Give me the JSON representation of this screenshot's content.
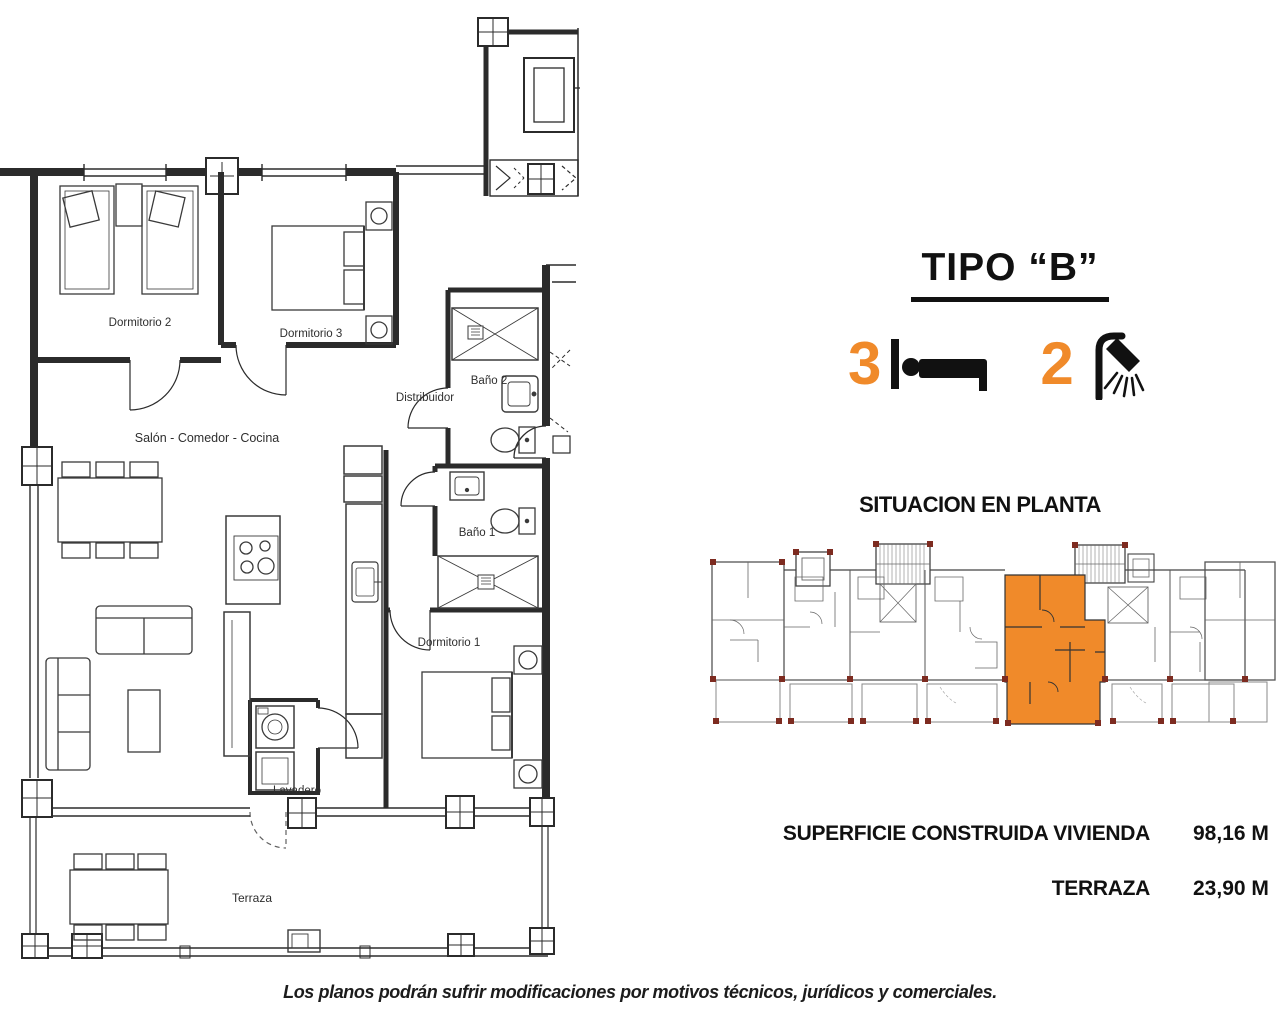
{
  "header": {
    "title": "TIPO “B”"
  },
  "features": {
    "bedrooms": {
      "count": "3",
      "icon": "bed-icon"
    },
    "bathrooms": {
      "count": "2",
      "icon": "shower-icon"
    }
  },
  "situacion": {
    "title": "SITUACION EN PLANTA"
  },
  "areas": {
    "rows": [
      {
        "label": "SUPERFICIE CONSTRUIDA VIVIENDA",
        "value": "98,16 M"
      },
      {
        "label": "TERRAZA",
        "value": "23,90 M"
      }
    ]
  },
  "floor_plan": {
    "rooms": [
      {
        "label": "Dormitorio 2"
      },
      {
        "label": "Dormitorio 3"
      },
      {
        "label": "Baño 2"
      },
      {
        "label": "Distribuidor"
      },
      {
        "label": "Salón - Comedor - Cocina"
      },
      {
        "label": "Baño 1"
      },
      {
        "label": "Dormitorio 1"
      },
      {
        "label": "Lavadero"
      },
      {
        "label": "Terraza"
      }
    ]
  },
  "disclaimer": "Los planos podrán sufrir modificaciones por motivos técnicos, jurídicos y comerciales.",
  "colors": {
    "accent_orange": "#F08A2A",
    "pillar_maroon": "#7D2B20",
    "plan_line": "#2B2B2B",
    "text": "#111111"
  }
}
